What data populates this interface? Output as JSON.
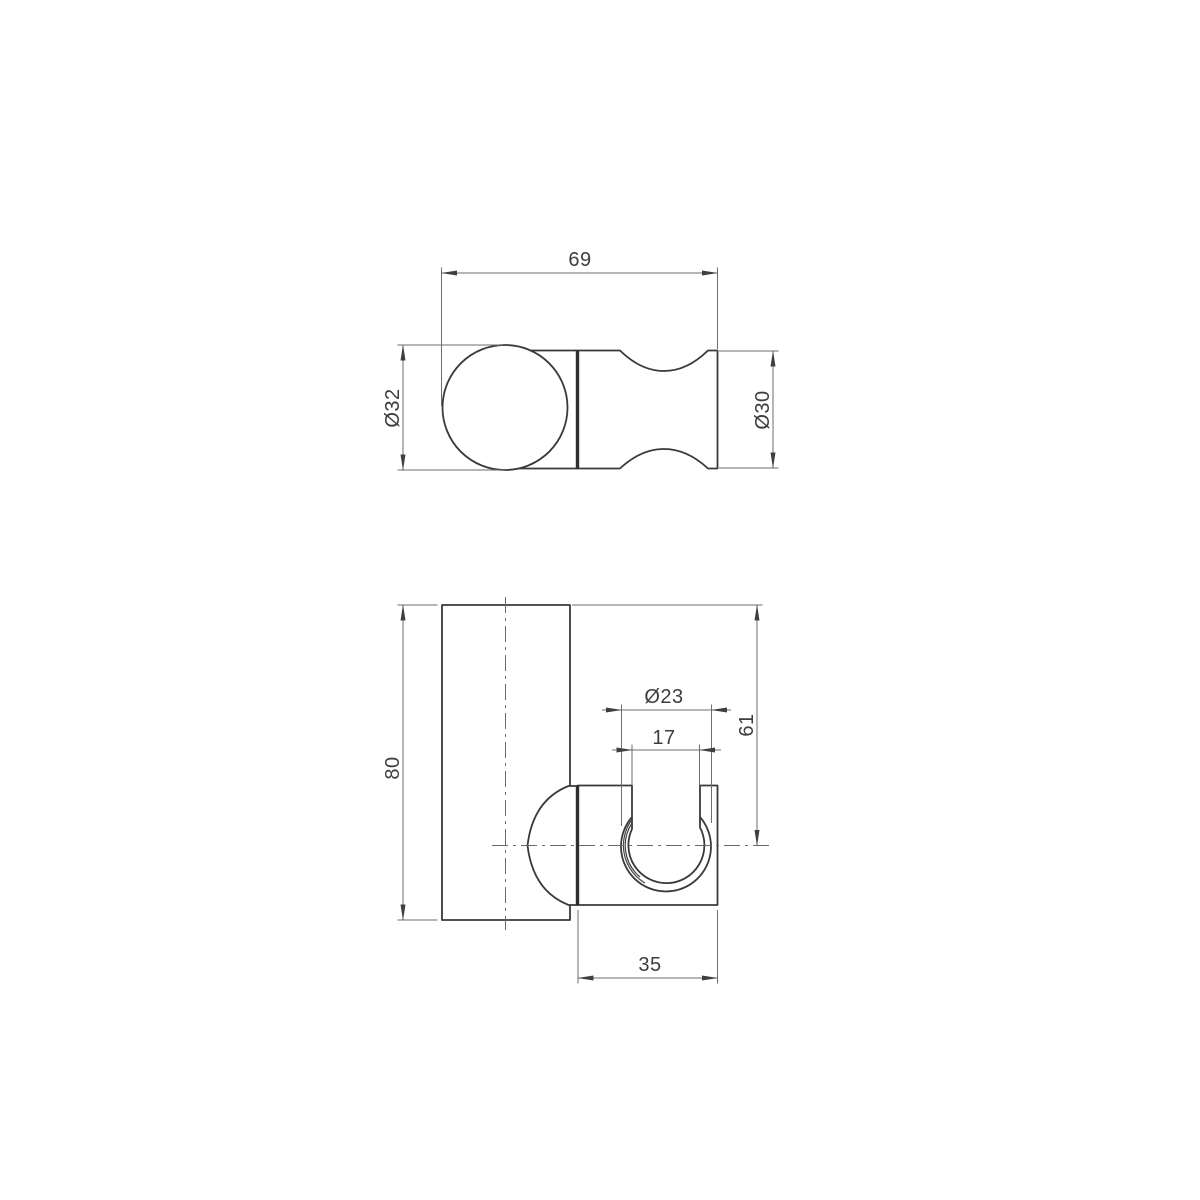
{
  "drawing": {
    "top_view": {
      "overall_width": "69",
      "ball_diameter": "Ø32",
      "body_diameter": "Ø30"
    },
    "front_view": {
      "plate_height": "80",
      "cup_outer_diameter": "Ø23",
      "cup_opening_width": "17",
      "top_to_center_offset": "61",
      "bracket_depth": "35"
    }
  },
  "colors": {
    "background": "#ffffff",
    "object_line": "#3a3a3a",
    "thick_joint_line": "#2e2e2e",
    "dimension_line": "#6e6e6e",
    "text": "#3d3d3d"
  }
}
